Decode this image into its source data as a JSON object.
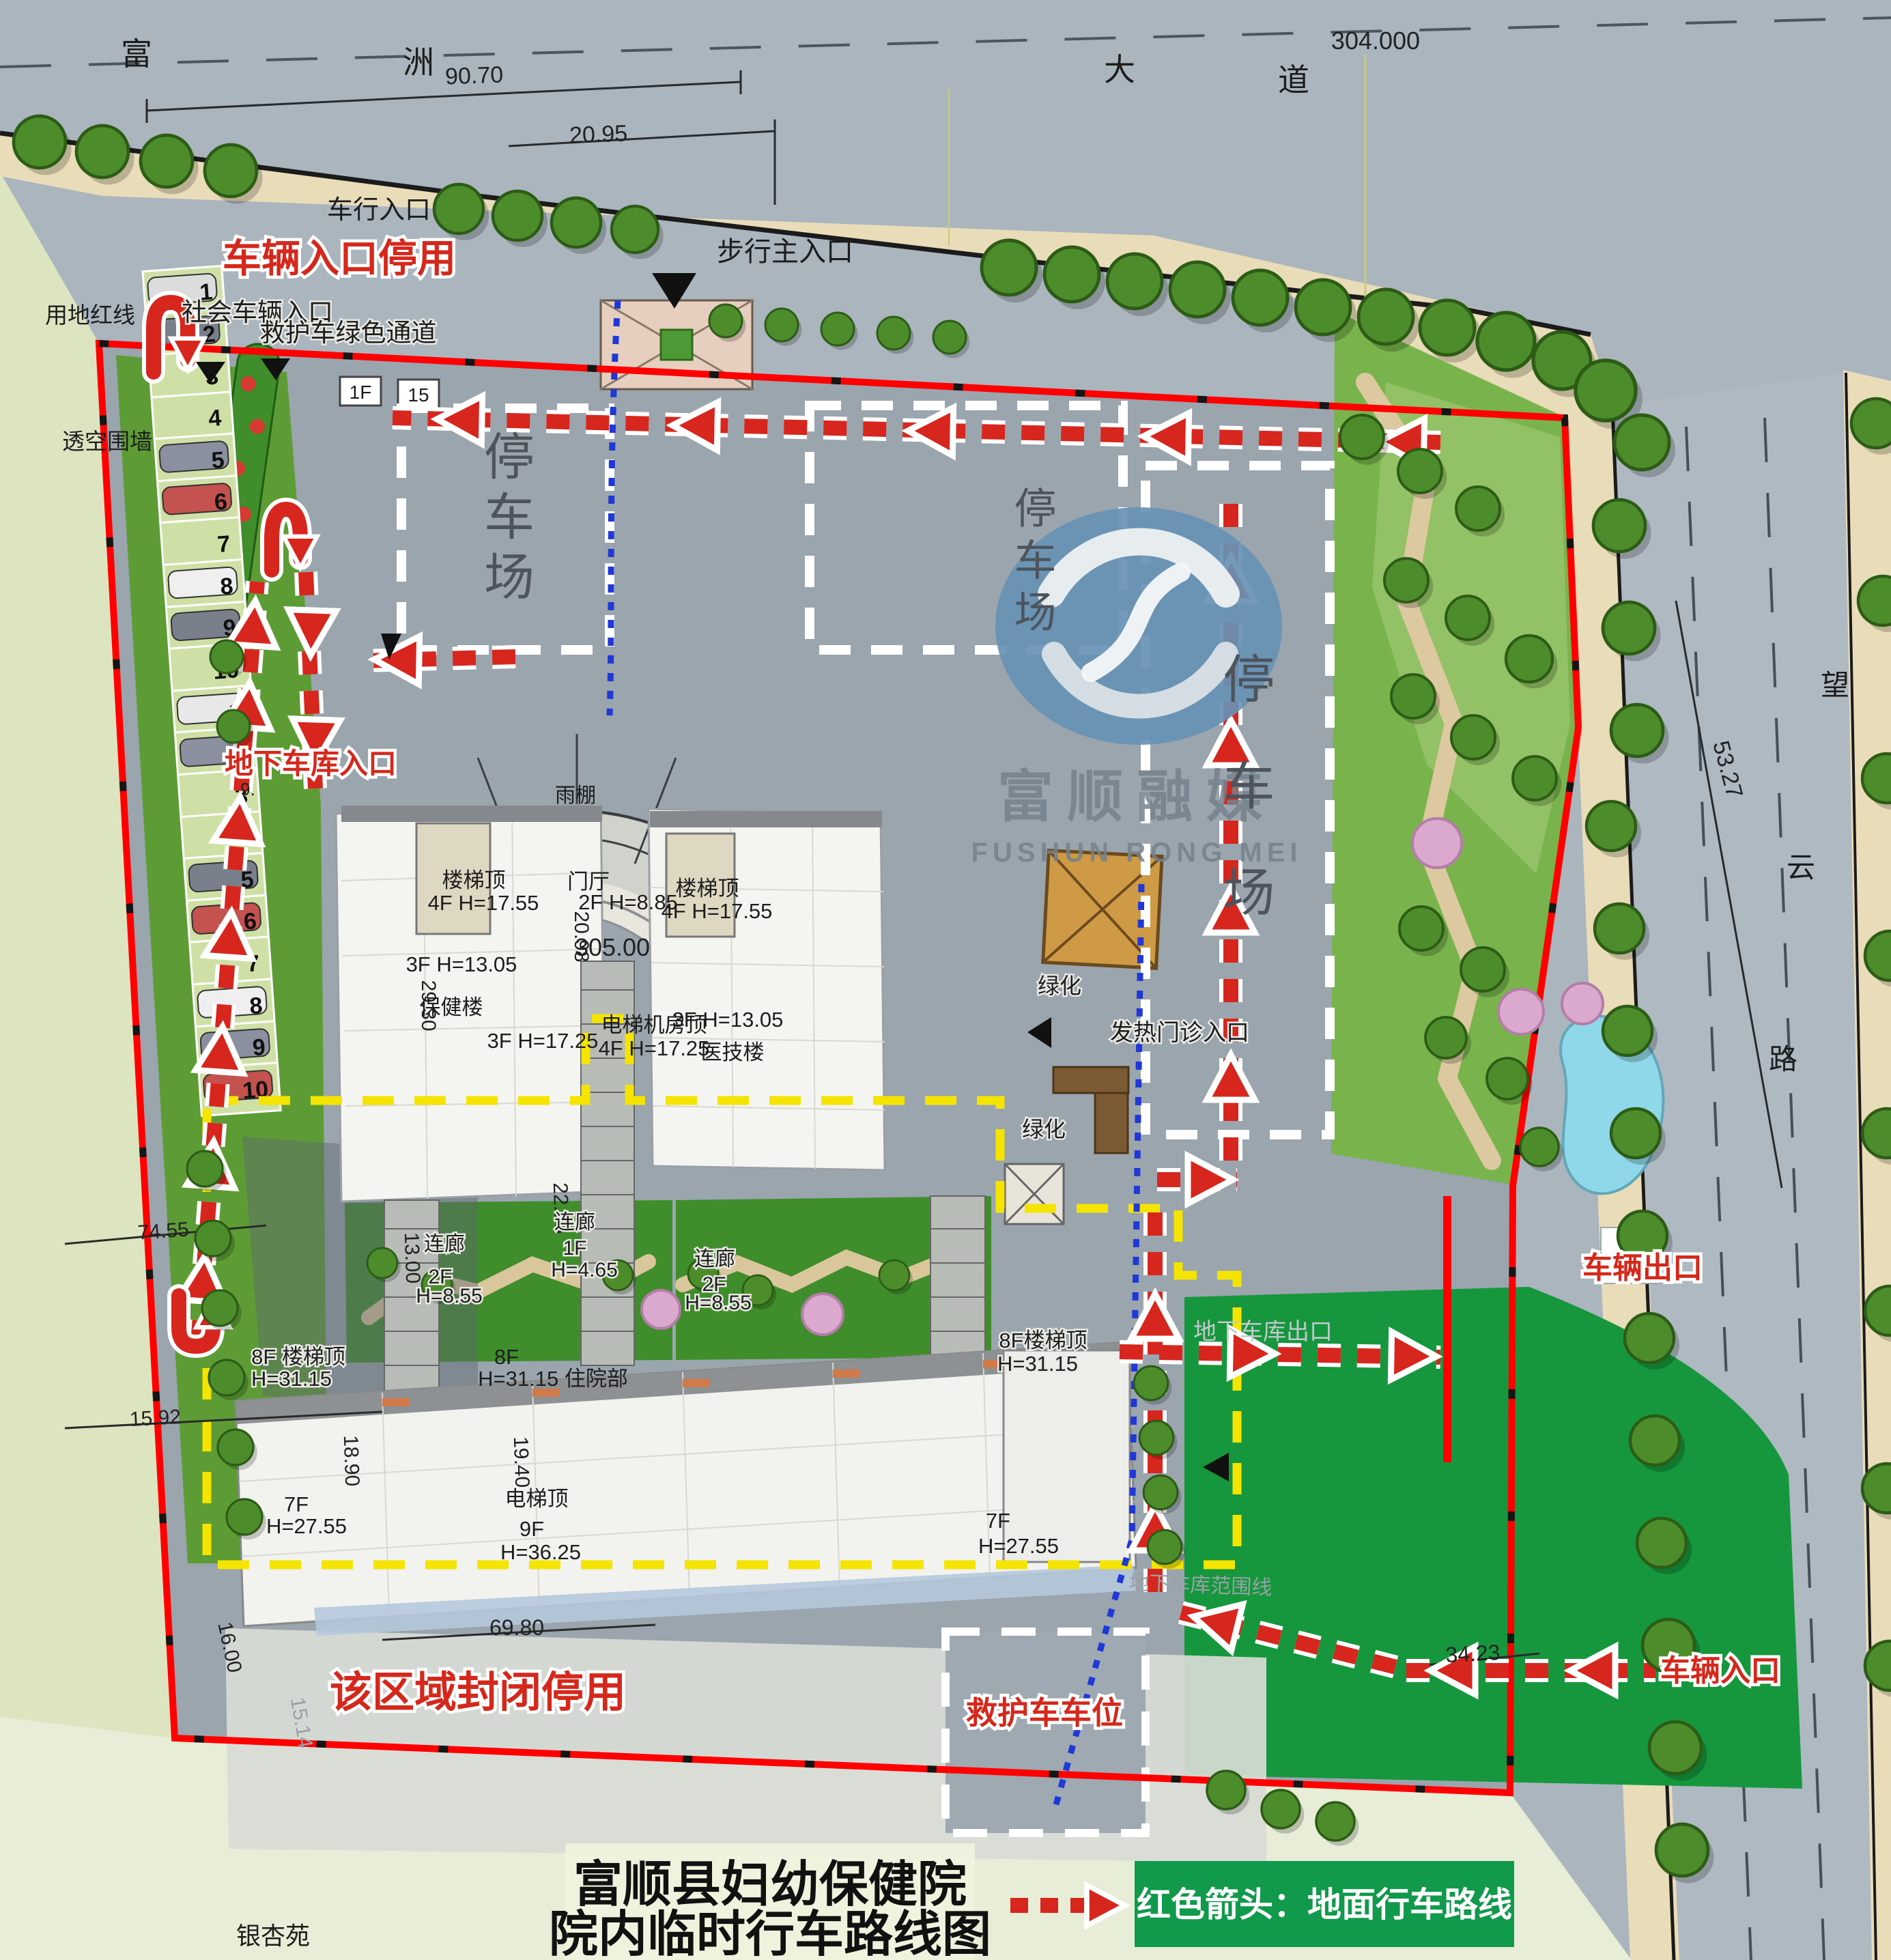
{
  "map_title": {
    "line1": "富顺县妇幼保健院",
    "line2": "院内临时行车路线图"
  },
  "legend": {
    "text": "红色箭头：地面行车路线"
  },
  "watermark": {
    "cn": "富顺融媒",
    "en": "FUSHUN RONG MEI"
  },
  "roads": {
    "top_chars": [
      "富",
      "洲",
      "大",
      "道"
    ],
    "right_chars": [
      "望",
      "云",
      "路"
    ]
  },
  "elevations": {
    "road": "304.000",
    "site": "305.00"
  },
  "dimensions": {
    "top_width": "90.70",
    "entry_width": "20.95",
    "right_road": "53.27",
    "west1": "74.55",
    "west2": "15.92",
    "west3": "16.00",
    "west4": "15.14",
    "building_width": "69.80",
    "bottom_entry": "34.23",
    "upper_depth": "29.30",
    "lobby_depth": "20.98",
    "corridor_left": "13.00",
    "corridor_mid": "22.98",
    "inpatient_depth": "18.90",
    "inpatient_mid": "19.40",
    "garage_note": "9."
  },
  "entrances": {
    "vehicle_top": "车行入口",
    "vehicle_top_disabled": "车辆入口停用",
    "social_vehicle": "社会车辆入口",
    "ambulance_channel": "救护车绿色通道",
    "pedestrian_main": "步行主入口",
    "underground_entry": "地下车库入口",
    "underground_exit": "地下车库出口",
    "underground_range": "地下车库范围线",
    "fever_clinic": "发热门诊入口",
    "vehicle_exit": "车辆出口",
    "vehicle_entry": "车辆入口",
    "ambulance_parking": "救护车车位",
    "closed_area": "该区域封闭停用"
  },
  "site": {
    "fence": "透空围墙",
    "red_line": "用地红线",
    "greenery": "绿化",
    "parking_lot": "停车场",
    "neighbor": "银杏苑",
    "gatehouse": "1F",
    "plot15": "15"
  },
  "buildings": {
    "canopy": "雨棚",
    "stair_top": "楼梯顶",
    "stair_top_h": "4F H=17.55",
    "lobby": "门厅",
    "lobby_h": "2F H=8.85",
    "care": "保健楼",
    "care_h": "3F H=13.05",
    "tech": "医技楼",
    "tech_h": "3F H=13.05",
    "mid_h": "3F H=17.25",
    "elev_room": "电梯机房顶",
    "elev_room_h": "4F H=17.25",
    "corridor": "连廊",
    "corridor_2f": "2F",
    "corridor_2f_h": "H=8.55",
    "corridor_1f": "1F",
    "corridor_1f_h": "H=4.65",
    "inpatient_stair": "8F 楼梯顶",
    "inpatient_stair_h": "H=31.15",
    "inpatient_f": "8F",
    "inpatient_h": "H=31.15 住院部",
    "inpatient_stair_r": "8F楼梯顶",
    "inpatient_stair_r_h": "H=31.15",
    "wing_7f": "7F",
    "wing_7f_h": "H=27.55",
    "elev_top": "电梯顶",
    "elev_top_f": "9F",
    "elev_top_h": "H=36.25"
  },
  "parking_numbers": {
    "col_a": [
      "1",
      "2",
      "3",
      "4",
      "5",
      "6",
      "7",
      "8",
      "9",
      "10"
    ],
    "col_b": [
      "1",
      "2",
      "3",
      "4",
      "5",
      "6",
      "7",
      "8",
      "9",
      "10"
    ]
  }
}
